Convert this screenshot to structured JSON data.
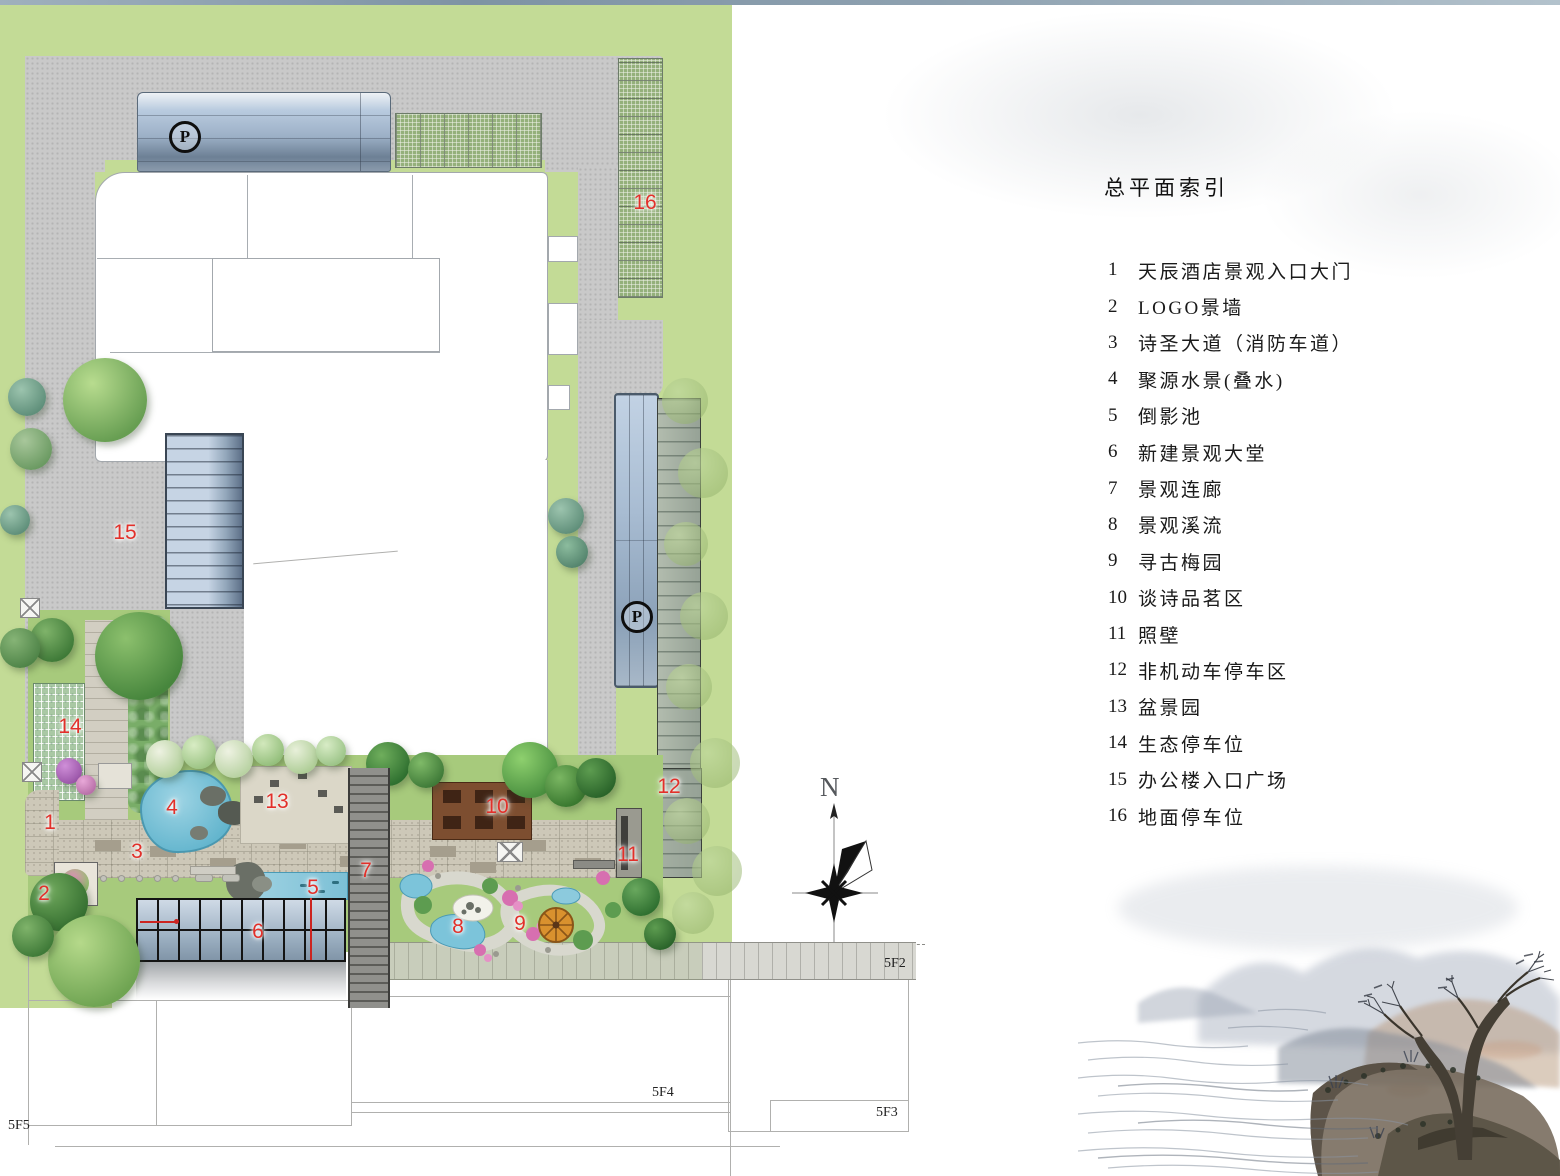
{
  "colors": {
    "label_red": "#e2302a",
    "lawn_green": "#c3db96",
    "garden_green": "#a7ca7c",
    "road_gray": "#c9c9c9",
    "glass_blue": "#9cb0c6",
    "water_blue": "#7cc4da",
    "deck_brown": "#7d4e30"
  },
  "plan": {
    "parking_symbol": "P",
    "north_symbol": "N",
    "area_labels": [
      "1",
      "2",
      "3",
      "4",
      "5",
      "6",
      "7",
      "8",
      "9",
      "10",
      "11",
      "12",
      "13",
      "14",
      "15",
      "16"
    ],
    "floor_labels": [
      "5F2",
      "5F3",
      "5F4",
      "5F5"
    ]
  },
  "legend": {
    "title": "总平面索引",
    "items": [
      {
        "num": "1",
        "label": "天辰酒店景观入口大门"
      },
      {
        "num": "2",
        "label": "LOGO景墙"
      },
      {
        "num": "3",
        "label": "诗圣大道（消防车道）"
      },
      {
        "num": "4",
        "label": "聚源水景(叠水)"
      },
      {
        "num": "5",
        "label": "倒影池"
      },
      {
        "num": "6",
        "label": "新建景观大堂"
      },
      {
        "num": "7",
        "label": "景观连廊"
      },
      {
        "num": "8",
        "label": "景观溪流"
      },
      {
        "num": "9",
        "label": "寻古梅园"
      },
      {
        "num": "10",
        "label": "谈诗品茗区"
      },
      {
        "num": "11",
        "label": "照壁"
      },
      {
        "num": "12",
        "label": "非机动车停车区"
      },
      {
        "num": "13",
        "label": "盆景园"
      },
      {
        "num": "14",
        "label": "生态停车位"
      },
      {
        "num": "15",
        "label": "办公楼入口广场"
      },
      {
        "num": "16",
        "label": "地面停车位"
      }
    ]
  }
}
